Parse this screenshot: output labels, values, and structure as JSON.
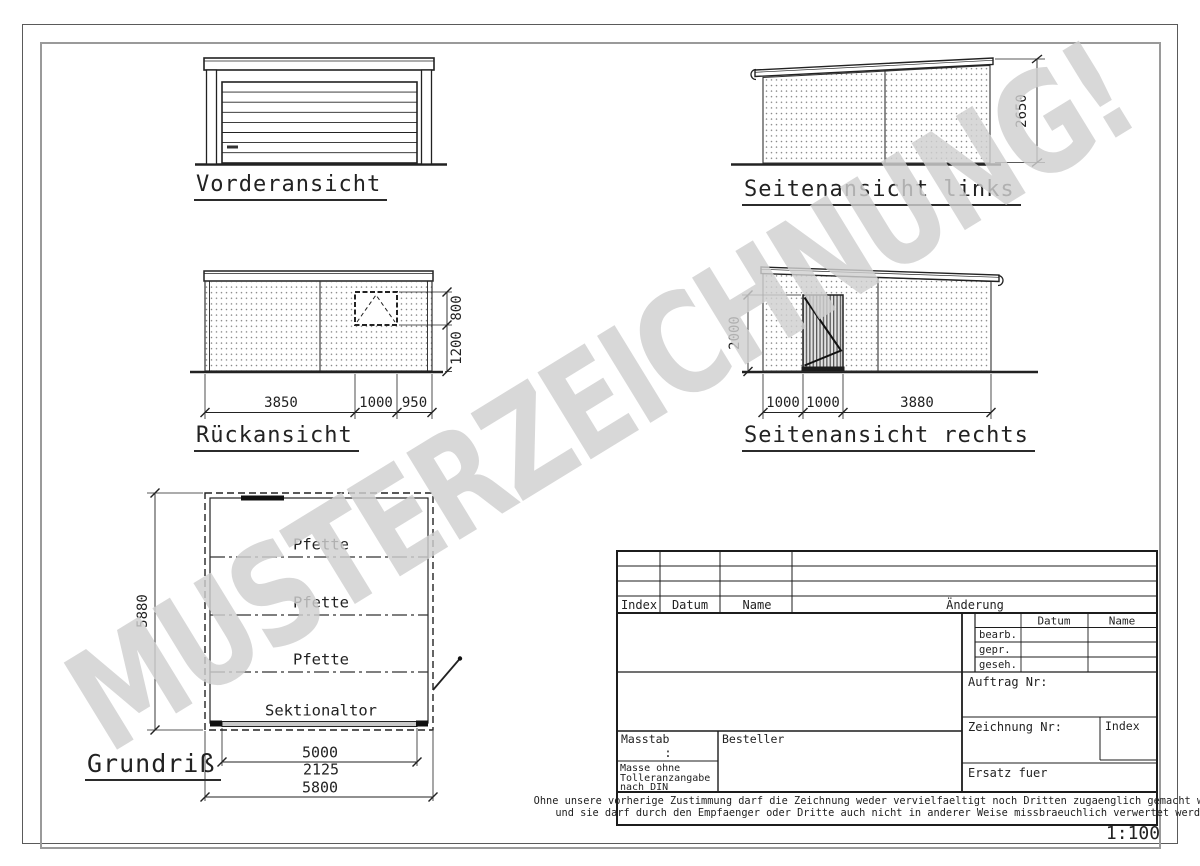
{
  "watermark": "MUSTERZEICHNUNG!",
  "scale": "1:100",
  "views": {
    "front": {
      "label": "Vorderansicht"
    },
    "side_left": {
      "label": "Seitenansicht links",
      "height": "2650"
    },
    "rear": {
      "label": "Rückansicht",
      "seg1": "3850",
      "seg2": "1000",
      "seg3": "950",
      "window_height": "800",
      "parapet_height": "1200"
    },
    "side_right": {
      "label": "Seitenansicht rechts",
      "seg1": "1000",
      "seg2": "1000",
      "seg3": "3880",
      "door_height": "2000"
    },
    "plan": {
      "label": "Grundriß",
      "purlins": [
        "Pfette",
        "Pfette",
        "Pfette"
      ],
      "door": "Sektionaltor",
      "depth": "5880",
      "door_width": "5000",
      "mid_width": "2125",
      "total_width": "5800"
    }
  },
  "title_block": {
    "revision_headers": {
      "index": "Index",
      "date": "Datum",
      "name": "Name",
      "change": "Änderung"
    },
    "approval": {
      "date": "Datum",
      "name": "Name",
      "rows": [
        "bearb.",
        "gepr.",
        "geseh."
      ]
    },
    "order_no": "Auftrag Nr:",
    "drawing_no": "Zeichnung Nr:",
    "index": "Index",
    "replacement": "Ersatz fuer",
    "scale_label": "Masstab",
    "scale_value": ":",
    "customer": "Besteller",
    "tolerance_note": [
      "Masse ohne",
      "Tolleranzangabe",
      "nach DIN"
    ],
    "disclaimer": [
      "Ohne unsere vorherige Zustimmung darf die Zeichnung weder vervielfaeltigt noch Dritten zugaenglich gemacht werden,",
      "und sie darf durch den Empfaenger oder Dritte auch nicht in anderer Weise missbraeuchlich verwertet werden."
    ]
  }
}
